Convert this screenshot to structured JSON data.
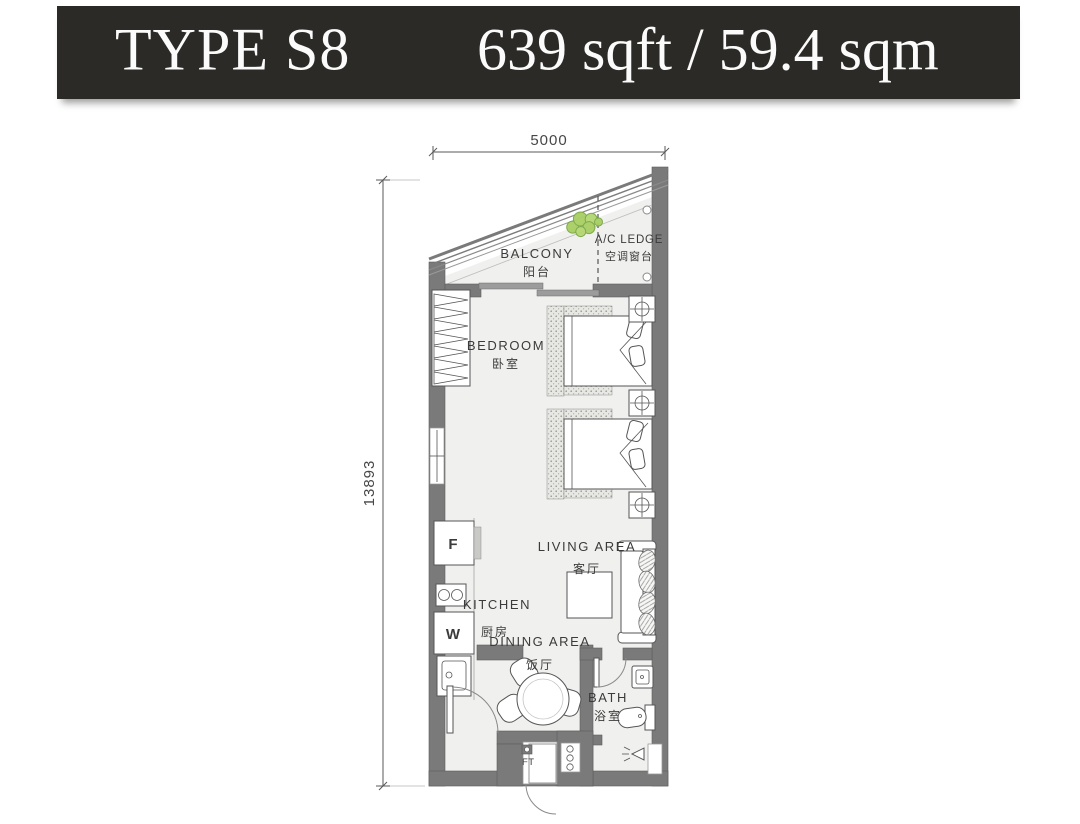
{
  "header": {
    "unit_type": "TYPE S8",
    "area": "639 sqft / 59.4 sqm"
  },
  "dimensions": {
    "top_width_mm": "5000",
    "left_height_mm": "13893"
  },
  "rooms": {
    "balcony": {
      "en": "BALCONY",
      "zh": "阳台"
    },
    "ac_ledge": {
      "en": "A/C LEDGE",
      "zh": "空调窗台"
    },
    "bedroom": {
      "en": "BEDROOM",
      "zh": "卧室"
    },
    "kitchen": {
      "en": "KITCHEN",
      "zh": "厨房"
    },
    "living_area": {
      "en": "LIVING AREA",
      "zh": "客厅"
    },
    "dining_area": {
      "en": "DINING AREA",
      "zh": "饭厅"
    },
    "bath": {
      "en": "BATH",
      "zh": "浴室"
    }
  },
  "appliances": {
    "fridge": "F",
    "washer": "W",
    "ft": "FT"
  },
  "colors": {
    "header_bg": "#2b2a27",
    "header_text": "#fbfbfb",
    "wall": "#7a7a7a",
    "floor": "#f0f0ee",
    "label": "#3b3b3b",
    "plant_fill": "#a8cf63",
    "plant_stroke": "#79a843"
  }
}
